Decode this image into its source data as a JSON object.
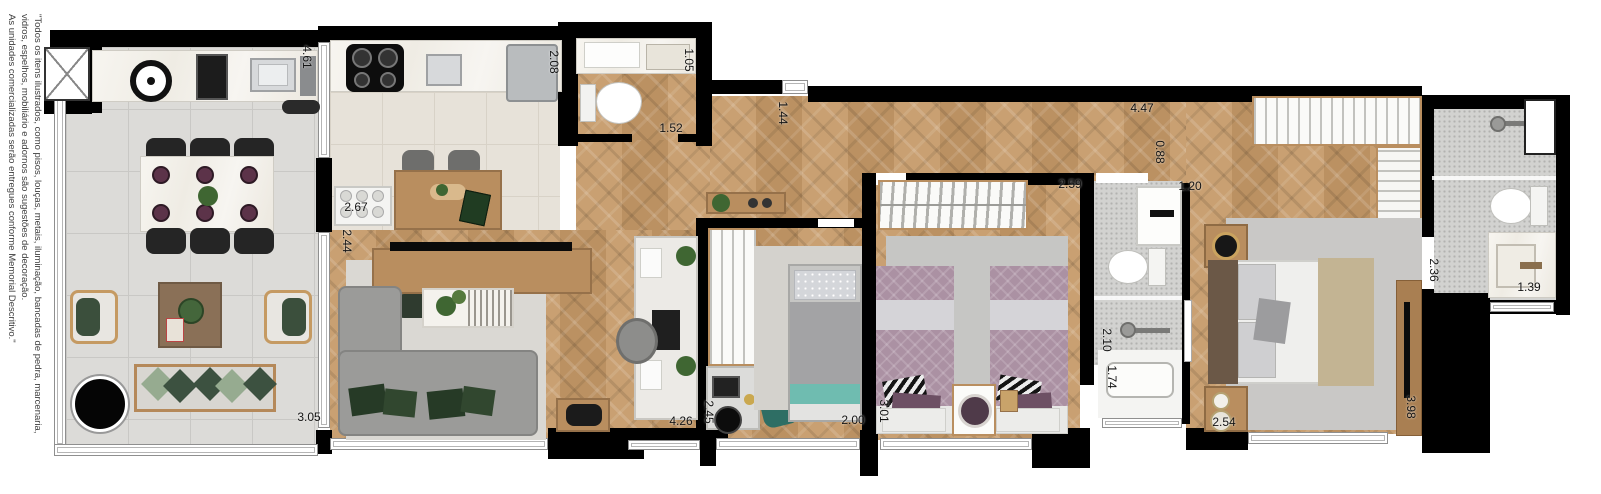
{
  "disclaimer": {
    "lines": [
      "\"Todos os itens ilustrados, como pisos, louças, metais, iluminação, bancadas de pedra, marcenaria,",
      "vidros, espelhos, mobiliário e adornos são sugestões de decoração.",
      "As unidades comercializadas serão entregues conforme Memorial Descritivo.\""
    ]
  },
  "dims": [
    {
      "v": "4.61",
      "area": "balcony",
      "orientation": "vertical"
    },
    {
      "v": "3.05",
      "area": "balcony",
      "orientation": "horizontal"
    },
    {
      "v": "2.67",
      "area": "kitchen",
      "orientation": "horizontal"
    },
    {
      "v": "2.08",
      "area": "kitchen",
      "orientation": "vertical"
    },
    {
      "v": "2.44",
      "area": "living",
      "orientation": "vertical"
    },
    {
      "v": "1.05",
      "area": "lavabo",
      "orientation": "vertical"
    },
    {
      "v": "1.52",
      "area": "lavabo",
      "orientation": "horizontal"
    },
    {
      "v": "1.44",
      "area": "hall",
      "orientation": "vertical"
    },
    {
      "v": "4.47",
      "area": "hall",
      "orientation": "horizontal"
    },
    {
      "v": "0.88",
      "area": "hall",
      "orientation": "vertical"
    },
    {
      "v": "4.26",
      "area": "office",
      "orientation": "horizontal"
    },
    {
      "v": "2.45",
      "area": "bedroom1",
      "orientation": "vertical"
    },
    {
      "v": "2.00",
      "area": "bedroom1",
      "orientation": "horizontal"
    },
    {
      "v": "2.59",
      "area": "bedroom2",
      "orientation": "horizontal"
    },
    {
      "v": "3.01",
      "area": "bedroom2",
      "orientation": "vertical"
    },
    {
      "v": "1.20",
      "area": "bathroom2",
      "orientation": "horizontal"
    },
    {
      "v": "2.10",
      "area": "bathroom2",
      "orientation": "vertical"
    },
    {
      "v": "1.74",
      "area": "bathroom2",
      "orientation": "vertical"
    },
    {
      "v": "2.54",
      "area": "master-bedroom",
      "orientation": "horizontal"
    },
    {
      "v": "3.98",
      "area": "master-bedroom",
      "orientation": "vertical"
    },
    {
      "v": "2.36",
      "area": "ensuite-bathroom",
      "orientation": "vertical"
    },
    {
      "v": "1.39",
      "area": "ensuite-bathroom",
      "orientation": "horizontal"
    }
  ],
  "colors": {
    "wall": "#000000",
    "wood_floor": "#c49a6c",
    "balcony_tile": "#dcdbd8",
    "bath_tile": "#d2d2d0",
    "mauve_bedding": "#ab91a3",
    "green_pillow": "#3c5140",
    "teal_accent": "#6fbcb0"
  }
}
